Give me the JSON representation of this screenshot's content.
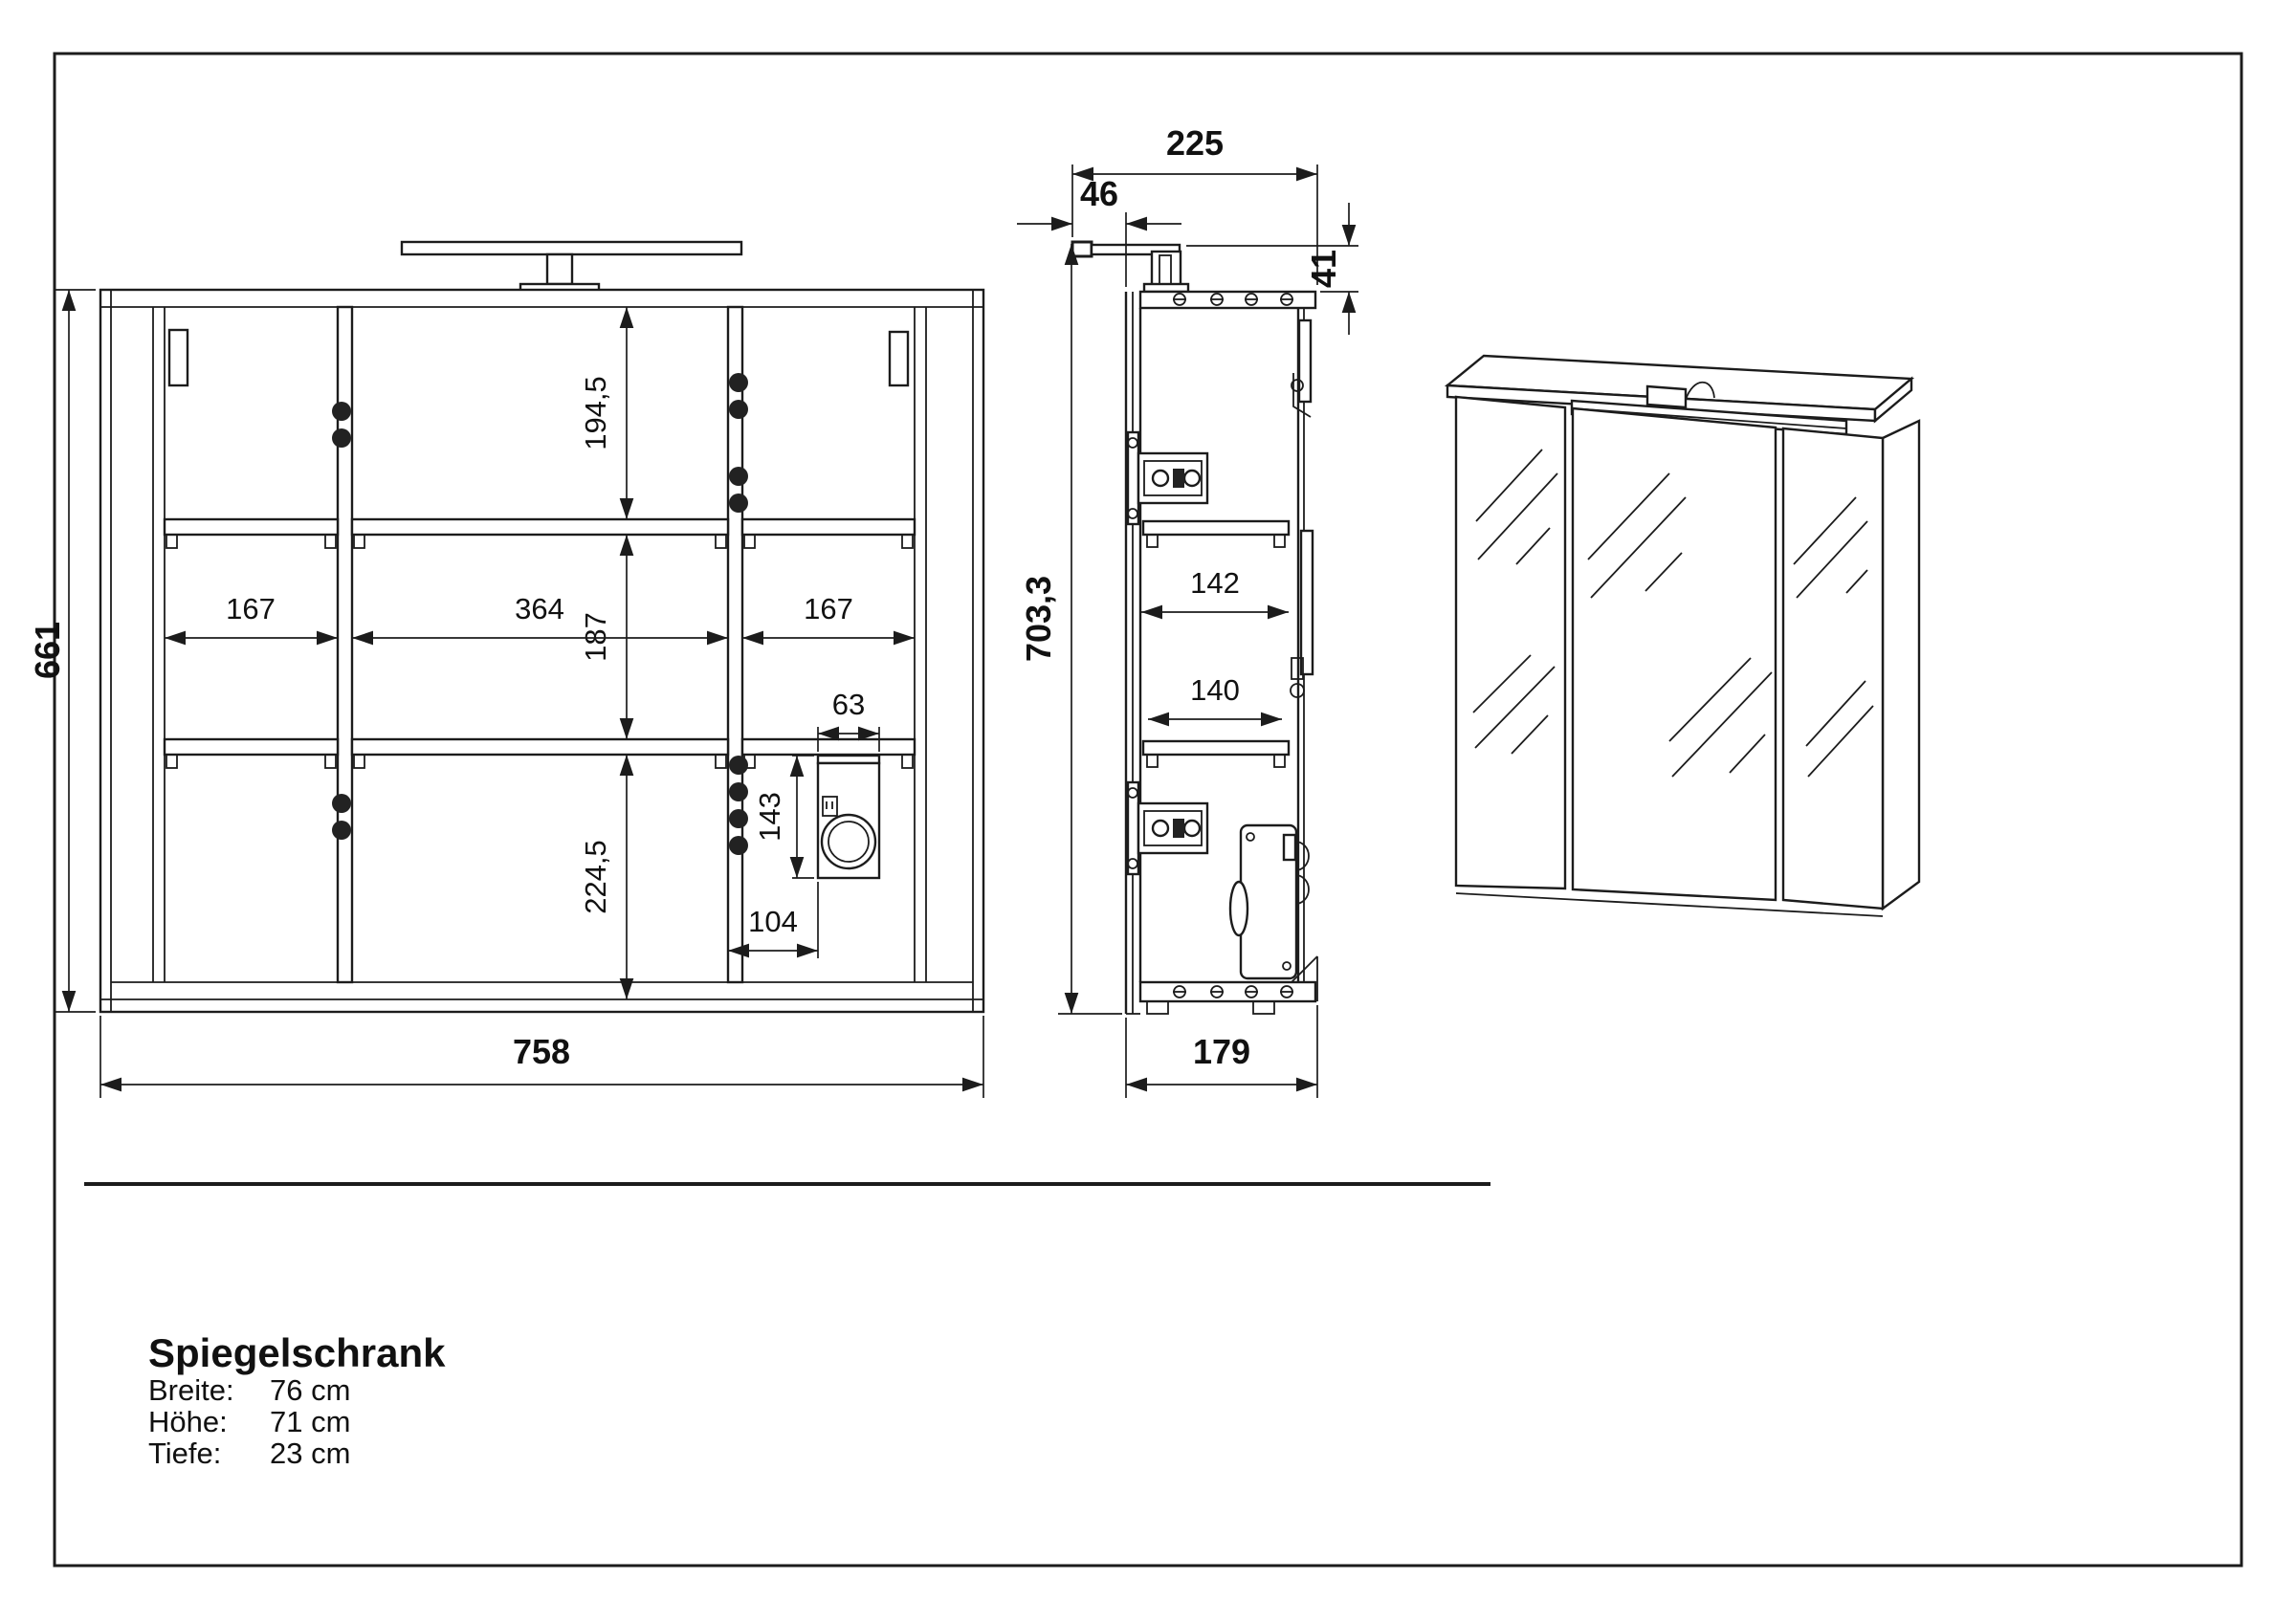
{
  "product": {
    "title": "Spiegelschrank",
    "specs": [
      {
        "label": "Breite:",
        "value": "76 cm"
      },
      {
        "label": "Höhe:",
        "value": "71 cm"
      },
      {
        "label": "Tiefe:",
        "value": "23 cm"
      }
    ]
  },
  "front_view": {
    "dim_height_total": "661",
    "dim_width_total": "758",
    "dim_cell_top_height": "194,5",
    "dim_cell_middle_height": "187",
    "dim_cell_bottom_height": "224,5",
    "dim_cell_left_width": "167",
    "dim_cell_center_width": "364",
    "dim_cell_right_width": "167",
    "dim_socket_box_width": "63",
    "dim_socket_box_height": "143",
    "dim_socket_box_offset": "104"
  },
  "side_view": {
    "dim_depth_with_lamp": "225",
    "dim_lamp_overhang": "46",
    "dim_lamp_above_top": "41",
    "dim_height_with_lamp": "703,3",
    "dim_shelf_depth_upper": "142",
    "dim_shelf_depth_lower": "140",
    "dim_body_depth": "179"
  },
  "colors": {
    "line": "#1c1c1c",
    "background": "#ffffff"
  }
}
